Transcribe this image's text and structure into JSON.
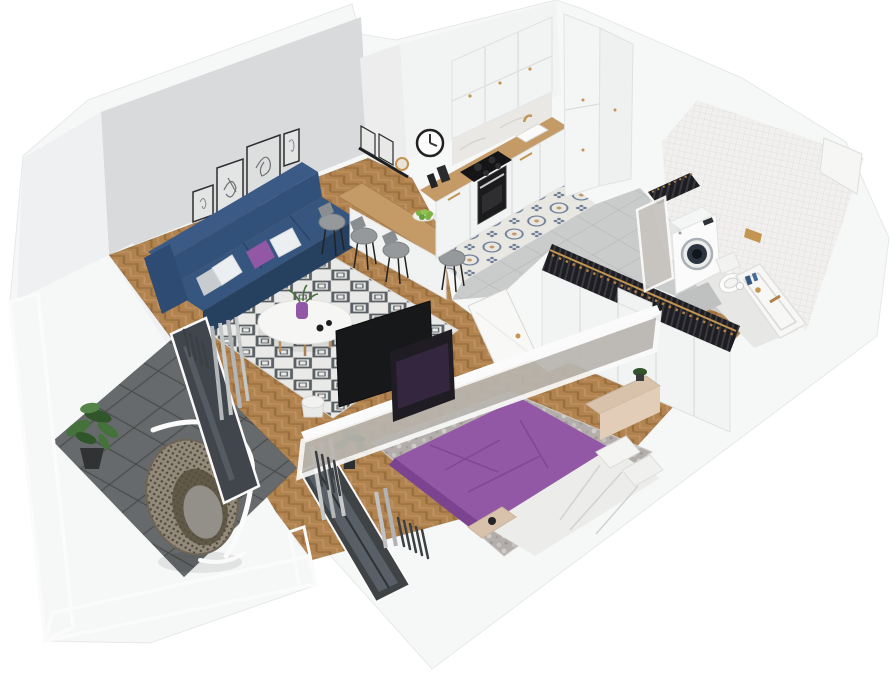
{
  "scene": {
    "type": "isometric-3d-apartment-floor-plan",
    "rooms": [
      {
        "id": "living-room",
        "objects": [
          "navy-sofa",
          "cushions-white-gray-purple",
          "diamond-pattern-rug",
          "round-coffee-table",
          "purple-vase",
          "gallery-wall-5-frames",
          "wall-shelf-with-mirror",
          "radiator",
          "curtain",
          "balcony-glass-door",
          "herringbone-wood-floor"
        ]
      },
      {
        "id": "kitchen",
        "objects": [
          "upper-cabinets",
          "base-cabinets",
          "tall-cabinets",
          "wood-countertop",
          "cooktop",
          "oven",
          "sink-gold-faucet",
          "wall-clock",
          "breakfast-bar",
          "bar-stools-x4",
          "plate-of-apples",
          "patterned-tile-strip",
          "gray-tile-floor"
        ]
      },
      {
        "id": "hallway",
        "objects": [
          "open-wardrobe-with-clothes",
          "wooden-hangers",
          "mirror-panel",
          "open-white-door"
        ]
      },
      {
        "id": "bathroom",
        "objects": [
          "mosaic-tile-walls",
          "wall-niche",
          "washing-machine",
          "wall-hung-toilet",
          "bathtub-vanity",
          "gold-flush-plate",
          "blue-bottles",
          "shower-mat"
        ]
      },
      {
        "id": "bedroom",
        "objects": [
          "double-bed-purple-duvet",
          "white-bedding-pillows",
          "mottled-gray-rug",
          "wardrobe-front",
          "dressing-table",
          "foot-bench",
          "dark-window",
          "curtains",
          "radiator",
          "potted-plant",
          "tv-partition-two-screens"
        ]
      },
      {
        "id": "balcony",
        "objects": [
          "dark-tile-floor",
          "mesh-railing-panels",
          "hanging-egg-chair",
          "potted-plant"
        ]
      }
    ],
    "counts": {
      "gallery_frames": 5,
      "bar_stools": 4,
      "sofa_cushions": 4,
      "tv_screens": 2
    }
  },
  "palette": {
    "wall_gray": "#d8dadb",
    "wood_floor": "#b1834f",
    "wood_floor_dark": "#996e3e",
    "wood_counter": "#c49b67",
    "tile_gray": "#cacbcb",
    "tile_pattern_base": "#e9e7e1",
    "tile_pattern_blue": "#6b7c97",
    "tile_pattern_tan": "#c39a6b",
    "balcony_tile": "#646768",
    "balcony_tile_line": "#454748",
    "mesh_gray": "#c3c6c7",
    "sofa_navy": "#31507a",
    "sofa_navy_dark": "#26405f",
    "pillow_white": "#eceff1",
    "pillow_gray": "#c9ccce",
    "accent_purple": "#9257a5",
    "purple_dark": "#7c4490",
    "rug_white": "#e9e9e7",
    "rug_diamond": "#5a5f63",
    "rug_bedroom": "#b3aeab",
    "tv_black": "#17181a",
    "glass_dark": "#41464d",
    "curtain_gray": "#b3b6b8",
    "radiator_dark": "#3c4043",
    "plant_green": "#45713a",
    "plant_green_dark": "#31552a",
    "rattan": "#948a7a",
    "rattan_dark": "#6e6557",
    "clothes_dark": "#26262a",
    "hanger_wood": "#b08048",
    "brass": "#c39550",
    "stool_gray": "#96999b",
    "machine_door": "#2c3440",
    "mosaic_tile": "#f1f0ee",
    "mosaic_line": "#dcdbd8",
    "wood_light": "#d9c2ac"
  }
}
